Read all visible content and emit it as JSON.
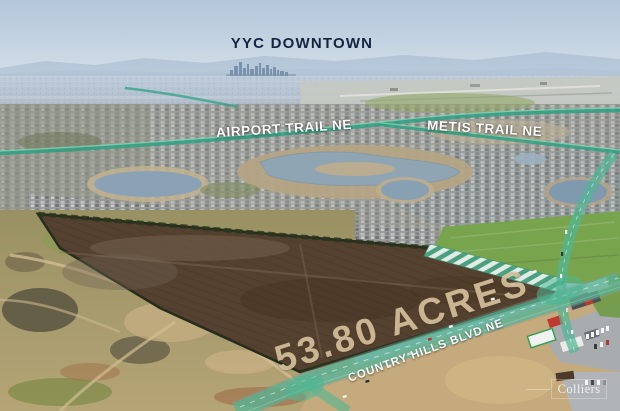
{
  "scene": {
    "type": "aerial-land-listing-photo",
    "subject": "vacant development parcel outlined with highlighted arterial roads"
  },
  "labels": {
    "downtown": "YYC DOWNTOWN",
    "airport_trail": "AIRPORT TRAIL NE",
    "metis_trail": "METIS TRAIL NE",
    "acreage": "53.80 ACRES",
    "country_hills_blvd": "COUNTRY HILLS BLVD NE",
    "watermark": "Colliers"
  },
  "colors": {
    "road_highlight_teal": "#4fb794",
    "parcel_soil": "#55412f",
    "acreage_text": "#d5c09b",
    "downtown_text": "#17243f",
    "road_label_text": "#ffffff",
    "boundary_hatch_green": "#4aa585"
  }
}
